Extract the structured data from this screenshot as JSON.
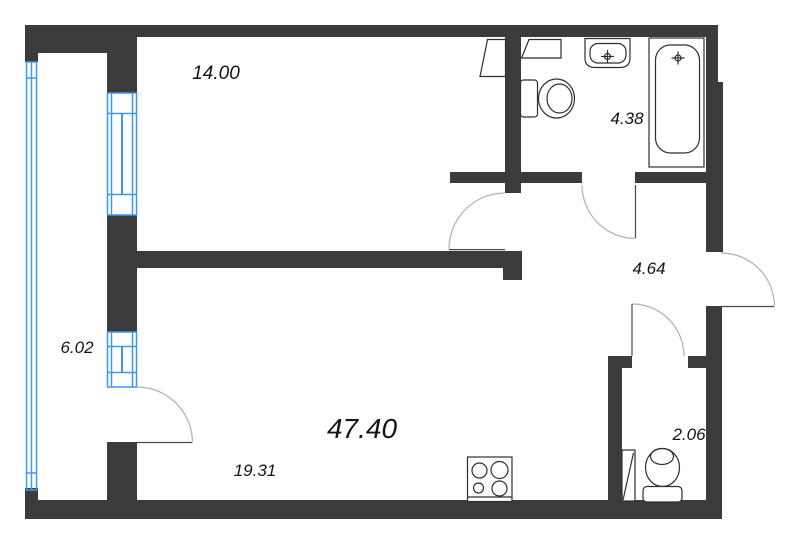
{
  "plan_type": "apartment-floor-plan",
  "total_area": "47.40",
  "rooms": [
    {
      "name": "bedroom",
      "area": "14.00"
    },
    {
      "name": "bathroom",
      "area": "4.38"
    },
    {
      "name": "hallway",
      "area": "4.64"
    },
    {
      "name": "balcony",
      "area": "6.02"
    },
    {
      "name": "kitchen-living-room",
      "area": "19.31"
    },
    {
      "name": "wc",
      "area": "2.06"
    }
  ],
  "fixtures": [
    "bathtub",
    "sink",
    "toilet-bathroom",
    "toilet-wc",
    "stove-4-burner",
    "wardrobe-bedroom",
    "wardrobe-bathroom",
    "wc-panel"
  ],
  "colors": {
    "wall": "#3b3b3b",
    "window": "#3f97f0",
    "door_arc": "#b4b4b4",
    "door_leaf": "#4a4a4a",
    "fixture": "#2f2f2f",
    "label": "#141414",
    "background": "#ffffff"
  }
}
